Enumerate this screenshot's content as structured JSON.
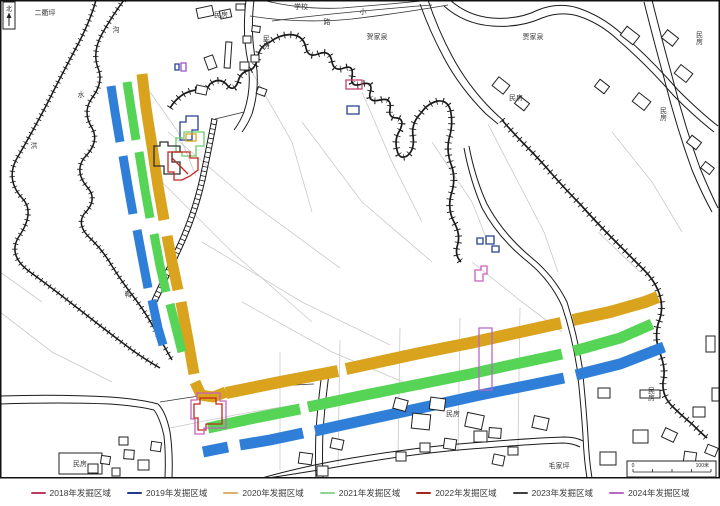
{
  "map": {
    "north_arrow_label": "北",
    "scale_bar": {
      "start_label": "0",
      "end_label": "100米"
    },
    "labels": [
      {
        "text": "二衢坪",
        "x": 45,
        "y": 15
      },
      {
        "text": "沟",
        "x": 116,
        "y": 32
      },
      {
        "text": "水",
        "x": 81,
        "y": 97
      },
      {
        "text": "洪",
        "x": 34,
        "y": 148
      },
      {
        "text": "民房",
        "x": 221,
        "y": 17
      },
      {
        "text": "学校",
        "x": 301,
        "y": 9
      },
      {
        "text": "小",
        "x": 363,
        "y": 14
      },
      {
        "text": "路",
        "x": 327,
        "y": 24
      },
      {
        "text": "贺家泉",
        "x": 377,
        "y": 39
      },
      {
        "text": "民房",
        "x": 266,
        "y": 42,
        "vertical": true
      },
      {
        "text": "贾家泉",
        "x": 533,
        "y": 39
      },
      {
        "text": "民房",
        "x": 699,
        "y": 38,
        "vertical": true
      },
      {
        "text": "民房",
        "x": 516,
        "y": 100
      },
      {
        "text": "民房",
        "x": 663,
        "y": 114,
        "vertical": true
      },
      {
        "text": "鸭",
        "x": 128,
        "y": 297
      },
      {
        "text": "民房",
        "x": 453,
        "y": 416
      },
      {
        "text": "民房",
        "x": 651,
        "y": 394,
        "vertical": true
      },
      {
        "text": "毛家坪",
        "x": 559,
        "y": 468
      },
      {
        "text": "民房",
        "x": 80,
        "y": 466
      }
    ],
    "features": {
      "bands": [
        {
          "year": "2020",
          "color": "#D9A31E",
          "width": 11,
          "segments": [
            [
              [
                142,
                74
              ],
              [
                146,
                108
              ],
              [
                152,
                146
              ],
              [
                158,
                186
              ],
              [
                164,
                220
              ]
            ],
            [
              [
                167,
                236
              ],
              [
                172,
                262
              ],
              [
                178,
                290
              ]
            ],
            [
              [
                181,
                302
              ],
              [
                188,
                340
              ],
              [
                194,
                374
              ]
            ],
            [
              [
                195,
                382
              ],
              [
                201,
                395
              ],
              [
                213,
                397
              ],
              [
                226,
                392
              ]
            ]
          ]
        },
        {
          "year": "2020",
          "color": "#D9A31E",
          "width": 12,
          "segments": [
            [
              [
                226,
                393
              ],
              [
                280,
                382
              ],
              [
                338,
                371
              ]
            ],
            [
              [
                346,
                369
              ],
              [
                420,
                353
              ],
              [
                470,
                343
              ],
              [
                520,
                332
              ],
              [
                561,
                323
              ]
            ],
            [
              [
                573,
                320
              ],
              [
                610,
                312
              ],
              [
                645,
                302
              ],
              [
                658,
                297
              ]
            ]
          ]
        },
        {
          "year": "2021",
          "color": "#56D456",
          "width": 9,
          "segments": [
            [
              [
                127,
                82
              ],
              [
                131,
                108
              ],
              [
                136,
                140
              ]
            ],
            [
              [
                139,
                152
              ],
              [
                145,
                190
              ],
              [
                150,
                218
              ]
            ],
            [
              [
                154,
                234
              ],
              [
                160,
                266
              ],
              [
                166,
                292
              ]
            ],
            [
              [
                170,
                304
              ],
              [
                177,
                332
              ],
              [
                182,
                352
              ]
            ]
          ]
        },
        {
          "year": "2021",
          "color": "#56D456",
          "width": 11,
          "segments": [
            [
              [
                208,
                428
              ],
              [
                250,
                419
              ],
              [
                300,
                409
              ]
            ],
            [
              [
                308,
                407
              ],
              [
                360,
                396
              ],
              [
                420,
                384
              ],
              [
                470,
                374
              ],
              [
                520,
                363
              ],
              [
                562,
                354
              ]
            ],
            [
              [
                574,
                351
              ],
              [
                620,
                338
              ],
              [
                652,
                324
              ]
            ]
          ]
        },
        {
          "year": "2019",
          "color": "#2F7FD8",
          "width": 9,
          "segments": [
            [
              [
                111,
                86
              ],
              [
                115,
                112
              ],
              [
                120,
                142
              ]
            ],
            [
              [
                123,
                156
              ],
              [
                128,
                186
              ],
              [
                133,
                214
              ]
            ],
            [
              [
                137,
                230
              ],
              [
                143,
                262
              ],
              [
                148,
                288
              ]
            ],
            [
              [
                152,
                300
              ],
              [
                158,
                328
              ],
              [
                163,
                345
              ]
            ]
          ]
        },
        {
          "year": "2019",
          "color": "#2F7FD8",
          "width": 11,
          "segments": [
            [
              [
                203,
                452
              ],
              [
                228,
                447
              ]
            ],
            [
              [
                240,
                445
              ],
              [
                270,
                440
              ],
              [
                303,
                433
              ]
            ],
            [
              [
                315,
                431
              ],
              [
                370,
                419
              ],
              [
                430,
                406
              ],
              [
                480,
                395
              ],
              [
                530,
                385
              ],
              [
                564,
                378
              ]
            ],
            [
              [
                576,
                375
              ],
              [
                620,
                364
              ],
              [
                664,
                347
              ]
            ]
          ]
        }
      ],
      "outlines": [
        {
          "year": "2019",
          "color": "#23408F",
          "close": true,
          "points": [
            [
              180,
              140
            ],
            [
              180,
              122
            ],
            [
              186,
              122
            ],
            [
              186,
              116
            ],
            [
              198,
              116
            ],
            [
              198,
              130
            ],
            [
              192,
              130
            ],
            [
              192,
              140
            ]
          ]
        },
        {
          "year": "2021",
          "color": "#6CC96C",
          "close": true,
          "points": [
            [
              176,
              152
            ],
            [
              176,
              138
            ],
            [
              184,
              138
            ],
            [
              184,
              132
            ],
            [
              204,
              132
            ],
            [
              204,
              146
            ],
            [
              196,
              146
            ],
            [
              196,
              156
            ],
            [
              182,
              156
            ],
            [
              182,
              152
            ]
          ]
        },
        {
          "year": "2020",
          "color": "#D9A31E",
          "close": true,
          "points": [
            [
              186,
              141
            ],
            [
              186,
              134
            ],
            [
              196,
              134
            ],
            [
              196,
              141
            ]
          ]
        },
        {
          "year": "2023",
          "color": "#2F2F2F",
          "close": true,
          "points": [
            [
              154,
              146
            ],
            [
              160,
              146
            ],
            [
              160,
              142
            ],
            [
              168,
              142
            ],
            [
              168,
              146
            ],
            [
              180,
              146
            ],
            [
              180,
              152
            ],
            [
              172,
              152
            ],
            [
              172,
              162
            ],
            [
              180,
              162
            ],
            [
              180,
              174
            ],
            [
              164,
              174
            ],
            [
              164,
              166
            ],
            [
              154,
              166
            ]
          ]
        },
        {
          "year": "2022",
          "color": "#C3271B",
          "close": true,
          "points": [
            [
              168,
              152
            ],
            [
              190,
              152
            ],
            [
              190,
              158
            ],
            [
              198,
              158
            ],
            [
              198,
              170
            ],
            [
              190,
              176
            ],
            [
              182,
              180
            ],
            [
              174,
              180
            ],
            [
              174,
              172
            ],
            [
              168,
              172
            ]
          ]
        },
        {
          "year": "2022",
          "color": "#C3271B",
          "close": false,
          "points": [
            [
              172,
              158
            ],
            [
              188,
              174
            ]
          ]
        },
        {
          "year": "2022",
          "color": "#C3271B",
          "close": true,
          "points": [
            [
              200,
              398
            ],
            [
              216,
              398
            ],
            [
              216,
              404
            ],
            [
              222,
              404
            ],
            [
              222,
              424
            ],
            [
              206,
              424
            ],
            [
              206,
              430
            ],
            [
              198,
              430
            ],
            [
              198,
              418
            ],
            [
              194,
              418
            ],
            [
              194,
              404
            ],
            [
              200,
              404
            ]
          ]
        },
        {
          "year": "2024",
          "color": "#C95FC0",
          "close": true,
          "points": [
            [
              197,
              393
            ],
            [
              220,
              393
            ],
            [
              220,
              401
            ],
            [
              226,
              401
            ],
            [
              226,
              428
            ],
            [
              204,
              428
            ],
            [
              204,
              434
            ],
            [
              195,
              434
            ],
            [
              195,
              419
            ],
            [
              191,
              419
            ],
            [
              191,
              400
            ],
            [
              197,
              400
            ]
          ]
        },
        {
          "year": "2024",
          "color": "#B966C5",
          "close": true,
          "points": [
            [
              479,
              328
            ],
            [
              492,
              328
            ],
            [
              492,
              390
            ],
            [
              479,
              390
            ]
          ]
        },
        {
          "year": "2018",
          "color": "#C73E6B",
          "close": true,
          "points": [
            [
              346,
              80
            ],
            [
              362,
              80
            ],
            [
              362,
              89
            ],
            [
              346,
              89
            ]
          ]
        },
        {
          "year": "2019",
          "color": "#23408F",
          "close": true,
          "points": [
            [
              347,
              106
            ],
            [
              359,
              106
            ],
            [
              359,
              114
            ],
            [
              347,
              114
            ]
          ]
        },
        {
          "year": "2019",
          "color": "#23408F",
          "close": true,
          "points": [
            [
              175,
              64
            ],
            [
              179,
              64
            ],
            [
              179,
              70
            ],
            [
              175,
              70
            ]
          ]
        },
        {
          "year": "2024",
          "color": "#9A4FC0",
          "close": true,
          "points": [
            [
              181,
              63
            ],
            [
              186,
              63
            ],
            [
              186,
              71
            ],
            [
              181,
              71
            ]
          ]
        },
        {
          "year": "2019",
          "color": "#23408F",
          "close": true,
          "points": [
            [
              477,
              238
            ],
            [
              483,
              238
            ],
            [
              483,
              244
            ],
            [
              477,
              244
            ]
          ]
        },
        {
          "year": "2019",
          "color": "#23408F",
          "close": true,
          "points": [
            [
              486,
              236
            ],
            [
              494,
              236
            ],
            [
              494,
              244
            ],
            [
              486,
              244
            ]
          ]
        },
        {
          "year": "2019",
          "color": "#23408F",
          "close": true,
          "points": [
            [
              492,
              246
            ],
            [
              499,
              246
            ],
            [
              499,
              252
            ],
            [
              492,
              252
            ]
          ]
        },
        {
          "year": "2024",
          "color": "#C95FC0",
          "close": true,
          "points": [
            [
              475,
              270
            ],
            [
              481,
              270
            ],
            [
              481,
              266
            ],
            [
              487,
              266
            ],
            [
              487,
              274
            ],
            [
              483,
              274
            ],
            [
              483,
              281
            ],
            [
              475,
              281
            ]
          ]
        }
      ]
    }
  },
  "legend": {
    "items": [
      {
        "label": "2018年发掘区域",
        "color": "#BE3A5E"
      },
      {
        "label": "2019年发掘区域",
        "color": "#1F3A8F"
      },
      {
        "label": "2020年发掘区域",
        "color": "#DFAE6B"
      },
      {
        "label": "2021年发掘区域",
        "color": "#8FD48F"
      },
      {
        "label": "2022年发掘区域",
        "color": "#A3271D"
      },
      {
        "label": "2023年发掘区域",
        "color": "#3F3F3F"
      },
      {
        "label": "2024年发掘区域",
        "color": "#B966C5"
      }
    ]
  }
}
